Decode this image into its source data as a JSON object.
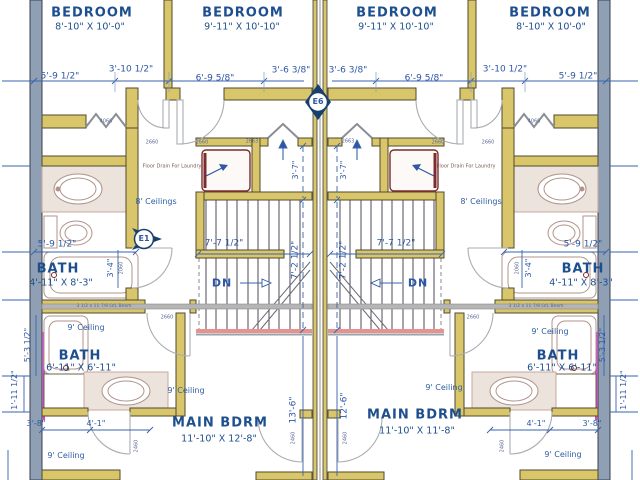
{
  "rooms": {
    "bedroom_l1": {
      "name": "BEDROOM",
      "size": "8'-10\" X 10'-0\""
    },
    "bedroom_l2": {
      "name": "BEDROOM",
      "size": "9'-11\" X 10'-10\""
    },
    "bedroom_r1": {
      "name": "BEDROOM",
      "size": "9'-11\" X 10'-10\""
    },
    "bedroom_r2": {
      "name": "BEDROOM",
      "size": "8'-10\" X 10'-0\""
    },
    "bath_upper_left": {
      "name": "BATH",
      "size": "4'-11\" X 8'-3\""
    },
    "bath_upper_right": {
      "name": "BATH",
      "size": "4'-11\" X 8'-3\""
    },
    "bath_lower_left": {
      "name": "BATH",
      "size": "6'-11\" X 6'-11\""
    },
    "bath_lower_right": {
      "name": "BATH",
      "size": "6'-11\" X 6'-11\""
    },
    "main_bdrm_left": {
      "name": "MAIN BDRM",
      "size": "11'-10\" X 12'-8\""
    },
    "main_bdrm_right": {
      "name": "MAIN BDRM",
      "size": "11'-10\" X 11'-8\""
    }
  },
  "ceilings": {
    "hall_left": "8' Ceilings",
    "hall_right": "8' Ceilings",
    "bath_lower_left": "9' Ceiling",
    "bath_lower_right": "9' Ceiling",
    "main_left": "9' Ceiling",
    "main_right": "9' Ceiling",
    "entry_left": "9' Ceiling",
    "entry_right": "9' Ceiling"
  },
  "dimensions": {
    "top": [
      "5'-9 1/2\"",
      "3'-10 1/2\"",
      "6'-9 5/8\"",
      "3'-6 3/8\"",
      "3'-6 3/8\"",
      "6'-9 5/8\"",
      "3'-10 1/2\"",
      "5'-9 1/2\""
    ],
    "bath_width_left": "5'-9 1/2\"",
    "bath_width_right": "5'-9 1/2\"",
    "stair_width_left": "7'-7 1/2\"",
    "stair_width_right": "7'-7 1/2\"",
    "stair_run_left": "7'-2 1/2\"",
    "stair_run_right": "7'-2 1/2\"",
    "stair_top_left": "3'-7\"",
    "stair_top_right": "3'-7\"",
    "bdrm_depth_left": "13'-6\"",
    "bdrm_depth_right": "12'-6\"",
    "bath_door_left": "3'-4\"",
    "bath_door_right": "3'-4\"",
    "tub_left": "5'-3 1/2\"",
    "tub_right": "5'-3 1/2\"",
    "vanity_left": "1'-11 1/2\"",
    "vanity_right": "1'-11 1/2\"",
    "closet_left_a": "3'-8\"",
    "closet_left_b": "4'-1\"",
    "closet_right_a": "4'-1\"",
    "closet_right_b": "3'-8\""
  },
  "annotations": {
    "floor_drain_left": "Floor Drain For Laundry",
    "floor_drain_right": "Floor Drain For Laundry",
    "beam_left": "3 1/2 x 11 7/8 LVL Beam",
    "beam_right": "3 1/2 x 11 7/8 LVL Beam",
    "down_left": "DN",
    "down_right": "DN"
  },
  "markers": {
    "e1": "E1",
    "e6": "E6"
  },
  "door_labels": {
    "bifold_left": "4066",
    "bifold_right": "4066",
    "bed_door_l1": "2660",
    "bed_door_l2": "2660",
    "bed_door_r1": "2660",
    "bed_door_r2": "2660",
    "attic_left": "2663",
    "attic_right": "2663",
    "hall_door_left": "2660",
    "hall_door_right": "2660",
    "bath_door_left": "2060",
    "bath_door_right": "2060",
    "bath2_door_left": "2460",
    "bath2_door_right": "2460",
    "closet_door_left": "2460",
    "closet_door_right": "2460"
  },
  "colors": {
    "wall_fill": "#d9c66b",
    "exterior_wall": "#8fa0b5",
    "party_accent": "#bd54bd",
    "room_text": "#1d4f8f",
    "dim_blue": "#3a63ad",
    "washer_red": "#7d2c2c",
    "counter_fill": "#ebe3dc",
    "stair_edge_pink": "#e8928e",
    "marker_navy": "#16406e",
    "beam_gray": "#b5b5b5"
  }
}
